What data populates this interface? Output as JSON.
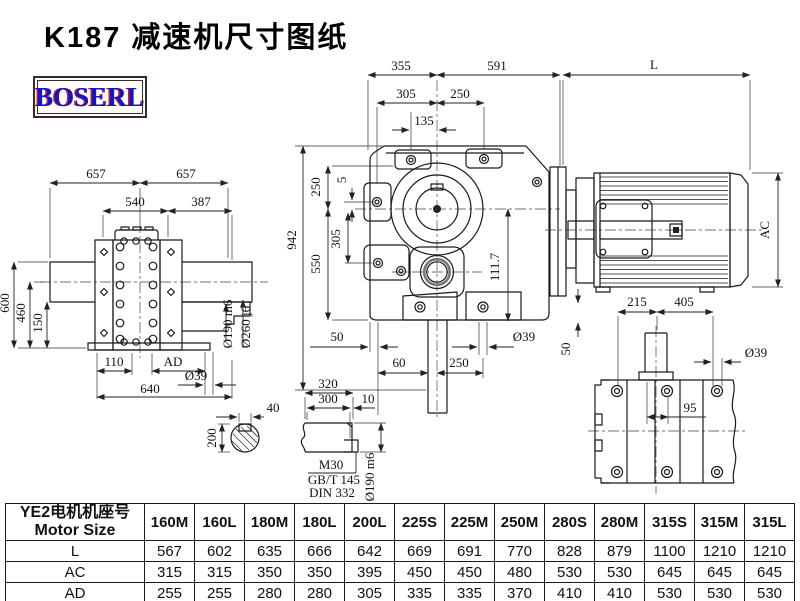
{
  "page": {
    "title": "K187 减速机尺寸图纸",
    "logo": "BOSERL"
  },
  "side_view": {
    "d657l": "657",
    "d657r": "657",
    "d540": "540",
    "d387": "387",
    "d600": "600",
    "d460": "460",
    "d150": "150",
    "d110": "110",
    "dAD": "AD",
    "d39": "Ø39",
    "d640": "640",
    "d190": "Ø190 m6",
    "d260": "Ø260 j6"
  },
  "front_view": {
    "d355": "355",
    "d591": "591",
    "d305t": "305",
    "d250t": "250",
    "d135": "135",
    "d942": "942",
    "d250l": "250",
    "d550": "550",
    "d5": "5",
    "d305l": "305",
    "d111": "111.7",
    "d50l": "50",
    "d39": "Ø39",
    "d60": "60",
    "d250b": "250",
    "d50r": "50"
  },
  "motor_view": {
    "dL": "L",
    "dAC": "AC"
  },
  "base_view": {
    "d215": "215",
    "d405": "405",
    "d39": "Ø39",
    "d95": "95"
  },
  "shaft_end": {
    "d40": "40",
    "d200": "200"
  },
  "shaft_side": {
    "d320": "320",
    "d300": "300",
    "d10": "10",
    "m30": "M30",
    "gbt": "GB/T 145",
    "din": "DIN 332",
    "d190": "Ø190 m6"
  },
  "table": {
    "header_cn": "YE2电机机座号",
    "header_en": "Motor Size",
    "columns": [
      "160M",
      "160L",
      "180M",
      "180L",
      "200L",
      "225S",
      "225M",
      "250M",
      "280S",
      "280M",
      "315S",
      "315M",
      "315L"
    ],
    "rows": [
      {
        "label": "L",
        "values": [
          567,
          602,
          635,
          666,
          642,
          669,
          691,
          770,
          828,
          879,
          1100,
          1210,
          1210
        ]
      },
      {
        "label": "AC",
        "values": [
          315,
          315,
          350,
          350,
          395,
          450,
          450,
          480,
          530,
          530,
          645,
          645,
          645
        ]
      },
      {
        "label": "AD",
        "values": [
          255,
          255,
          280,
          280,
          305,
          335,
          335,
          370,
          410,
          410,
          530,
          530,
          530
        ]
      }
    ]
  }
}
